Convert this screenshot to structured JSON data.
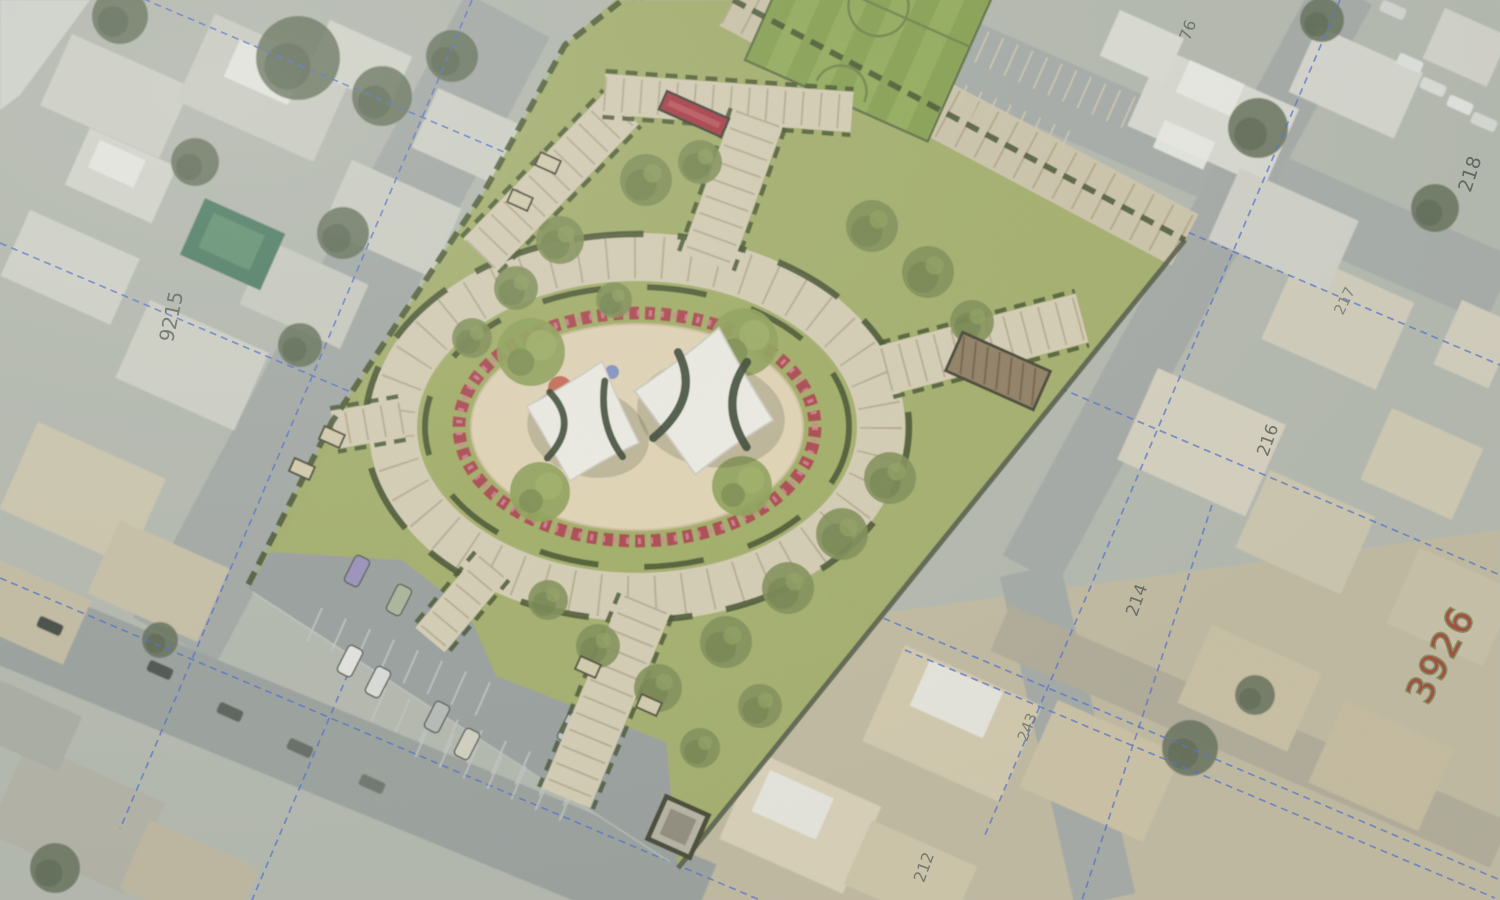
{
  "scene": {
    "description": "Aerial orthophoto of a city block with a landscape master-plan overlay of a neighborhood park: striped sports field, elliptical central plaza with two white shade-sail canopies, flower ring, hatched walkways, hedges, lawns with trees, and a parking lot with cars. Cadastral blue dashed parcel lines and rotated plot numbers over the satellite imagery.",
    "width": 1500,
    "height": 900
  },
  "colors": {
    "satellite_base": "#b5b9af",
    "beige_zone": "#c6bb9e",
    "lawn": "#a4af67",
    "tree_park": "#7d8d50",
    "tree_park_dark": "#66773f",
    "tree_park_light": "#93a35e",
    "tree_satellite": "#5f6b53",
    "path": "#d9d0b6",
    "path_hatch": "rgba(148,130,96,0.45)",
    "hedge": "#42502a",
    "boundary": "#4b5440",
    "sand": "#e6d7b7",
    "flower_red": "#ab4349",
    "flower_pink": "#d2808d",
    "parking_asphalt": "#999f9d",
    "parking_line": "#c2c7c3",
    "cadastral_blue": "#4f6ecb",
    "field_stripe_a": "#85a04c",
    "field_stripe_b": "#92ac57",
    "field_line": "#6e8245",
    "sail_fill": "#f2f0e8",
    "sail_edge": "#cfccc2",
    "sail_seam": "#323f2b",
    "pergola_fill": "#8f7b5f",
    "pergola_hatch": "#6e5d43",
    "bench_fill": "#d8cfae",
    "bench_stroke": "#4a4a35",
    "kiosk_fill": "#b9b4a4",
    "flowerbed_fill": "#a8323c",
    "white_roof": "#ecece6",
    "streak": "#d6d8d2"
  },
  "labels": [
    {
      "text": "9215",
      "x": 178,
      "y": 318,
      "rot": -78,
      "size": 20,
      "fill": "#565c55",
      "opacity": 0.85
    },
    {
      "text": "218",
      "x": 1476,
      "y": 176,
      "rot": -72,
      "size": 19,
      "fill": "#4e554e",
      "opacity": 0.9
    },
    {
      "text": "76",
      "x": 1193,
      "y": 32,
      "rot": -70,
      "size": 16,
      "fill": "#555b54",
      "opacity": 0.8
    },
    {
      "text": "217",
      "x": 1349,
      "y": 303,
      "rot": -64,
      "size": 15,
      "fill": "#5a6058",
      "opacity": 0.7
    },
    {
      "text": "216",
      "x": 1273,
      "y": 442,
      "rot": -70,
      "size": 17,
      "fill": "#51574f",
      "opacity": 0.85
    },
    {
      "text": "214",
      "x": 1142,
      "y": 602,
      "rot": -70,
      "size": 17,
      "fill": "#51574f",
      "opacity": 0.85
    },
    {
      "text": "243",
      "x": 1032,
      "y": 729,
      "rot": -68,
      "size": 15,
      "fill": "#5a5f56",
      "opacity": 0.75
    },
    {
      "text": "212",
      "x": 929,
      "y": 869,
      "rot": -70,
      "size": 16,
      "fill": "#565c55",
      "opacity": 0.8
    },
    {
      "text": "3926",
      "x": 1452,
      "y": 660,
      "rot": -62,
      "size": 36,
      "fill": "#9e3b2a",
      "opacity": 0.92,
      "serif": true,
      "halo": "#7d8a55"
    }
  ],
  "roads": [
    [
      508,
      15,
      175,
      640,
      95,
      "#a3a8a4"
    ],
    [
      0,
      618,
      700,
      905,
      88,
      "#9aa09c"
    ],
    [
      745,
      -40,
      1500,
      290,
      72,
      "#a6aba7"
    ],
    [
      1345,
      -10,
      1030,
      570,
      62,
      "#a4a9a5"
    ],
    [
      1030,
      570,
      1105,
      900,
      62,
      "#a4a9a5"
    ],
    [
      1000,
      628,
      1500,
      845,
      50,
      "#b2ab97"
    ]
  ],
  "beige_zone": [
    [
      660,
      900
    ],
    [
      640,
      800
    ],
    [
      830,
      620
    ],
    [
      1500,
      530
    ],
    [
      1500,
      900
    ]
  ],
  "corner_streak": [
    [
      0,
      0
    ],
    [
      90,
      0
    ],
    [
      20,
      95
    ],
    [
      0,
      110
    ]
  ],
  "buildings": [
    [
      72,
      34,
      130,
      78,
      "#d0d1c7"
    ],
    [
      215,
      14,
      150,
      95,
      "#cdcec4"
    ],
    [
      90,
      128,
      95,
      62,
      "#d6d6cc"
    ],
    [
      30,
      210,
      120,
      72,
      "#d3d4ca"
    ],
    [
      150,
      300,
      130,
      85,
      "#d0d1c6"
    ],
    [
      268,
      240,
      110,
      70,
      "#cbccc1"
    ],
    [
      352,
      160,
      120,
      75,
      "#cfd0c5"
    ],
    [
      438,
      88,
      100,
      65,
      "#d2d3c8"
    ],
    [
      330,
      20,
      90,
      55,
      "#d5d6cb"
    ],
    [
      38,
      422,
      140,
      95,
      "#cec6ad"
    ],
    [
      120,
      520,
      120,
      80,
      "#c9c0a6"
    ],
    [
      0,
      560,
      100,
      70,
      "#c4bca2"
    ],
    [
      28,
      742,
      150,
      100,
      "#b3b2a4"
    ],
    [
      150,
      820,
      120,
      75,
      "#c0b8a0"
    ],
    [
      0,
      680,
      90,
      60,
      "#a9aca1"
    ],
    [
      758,
      752,
      135,
      95,
      "#ddd3b8"
    ],
    [
      905,
      645,
      150,
      105,
      "#d6cbae"
    ],
    [
      1058,
      700,
      135,
      95,
      "#cfc3a5"
    ],
    [
      872,
      820,
      115,
      70,
      "#d2c7a9"
    ],
    [
      1212,
      625,
      120,
      85,
      "#cdc2a3"
    ],
    [
      1345,
      700,
      120,
      90,
      "#c8bd9e"
    ],
    [
      1158,
      368,
      140,
      100,
      "#d8d2bf"
    ],
    [
      1300,
      252,
      125,
      95,
      "#d4cebb"
    ],
    [
      1270,
      470,
      115,
      85,
      "#cfc7ae"
    ],
    [
      1392,
      408,
      100,
      78,
      "#d1cab1"
    ],
    [
      1420,
      548,
      105,
      82,
      "#cbc2a7"
    ],
    [
      1462,
      300,
      60,
      70,
      "#d6d0bd"
    ],
    [
      1162,
      48,
      150,
      85,
      "#dadad2"
    ],
    [
      1318,
      26,
      115,
      72,
      "#d7d7cf"
    ],
    [
      1445,
      8,
      70,
      55,
      "#d4d4cb"
    ],
    [
      1240,
      168,
      130,
      78,
      "#d2d2c9"
    ],
    [
      1120,
      10,
      70,
      50,
      "#dcdcd4"
    ]
  ],
  "white_roofs": [
    [
      240,
      40,
      70,
      40
    ],
    [
      100,
      140,
      50,
      30
    ],
    [
      1190,
      60,
      60,
      35
    ],
    [
      770,
      770,
      70,
      45
    ],
    [
      930,
      660,
      80,
      50
    ],
    [
      1165,
      120,
      55,
      30
    ]
  ],
  "pool": {
    "x": 205,
    "y": 198,
    "w": 88,
    "h": 62,
    "fill": "#497a5e",
    "inner": "#5d8f6e"
  },
  "satellite_trees": [
    [
      298,
      58,
      42
    ],
    [
      382,
      96,
      30
    ],
    [
      452,
      56,
      26
    ],
    [
      195,
      162,
      24
    ],
    [
      120,
      16,
      28
    ],
    [
      343,
      233,
      26
    ],
    [
      300,
      345,
      22
    ],
    [
      1258,
      128,
      30
    ],
    [
      1435,
      208,
      24
    ],
    [
      1322,
      20,
      22
    ],
    [
      55,
      868,
      25
    ],
    [
      160,
      640,
      18
    ],
    [
      1190,
      748,
      28
    ],
    [
      1255,
      695,
      20
    ]
  ],
  "street_cars": [
    [
      50,
      626,
      "#41463f"
    ],
    [
      160,
      670,
      "#4a4f49"
    ],
    [
      230,
      712,
      "#575c55"
    ],
    [
      300,
      748,
      "#626760"
    ],
    [
      372,
      784,
      "#6d716a"
    ],
    [
      1410,
      63,
      "#e2e3df"
    ],
    [
      1433,
      87,
      "#dcded9"
    ],
    [
      1460,
      105,
      "#e5e6e2"
    ],
    [
      1484,
      122,
      "#d8dad5"
    ],
    [
      1393,
      10,
      "#d4d6d1"
    ]
  ],
  "blue_lines": [
    [
      472,
      0,
      120,
      829
    ],
    [
      634,
      0,
      252,
      900
    ],
    [
      1340,
      0,
      985,
      835
    ],
    [
      1212,
      505,
      1082,
      900
    ],
    [
      0,
      243,
      1500,
      880
    ],
    [
      548,
      -40,
      1500,
      365
    ],
    [
      0,
      -62,
      1500,
      575
    ],
    [
      0,
      578,
      760,
      900
    ],
    [
      905,
      650,
      1495,
      898
    ]
  ],
  "park": {
    "lawn": [
      [
        615,
        0
      ],
      [
        733,
        0
      ],
      [
        1185,
        240
      ],
      [
        678,
        868
      ],
      [
        248,
        588
      ],
      [
        332,
        422
      ],
      [
        484,
        192
      ],
      [
        565,
        45
      ]
    ],
    "parking": {
      "poly": [
        [
          270,
          552
        ],
        [
          402,
          560
        ],
        [
          468,
          612
        ],
        [
          496,
          676
        ],
        [
          666,
          742
        ],
        [
          678,
          868
        ],
        [
          248,
          588
        ]
      ],
      "fill": "#999f9d"
    },
    "parking_rows": [
      [
        322,
        608,
        8
      ],
      [
        386,
        688,
        9
      ],
      [
        430,
        724,
        7
      ]
    ],
    "parking_edge_line": [
      252,
      592,
      670,
      862
    ],
    "plan_cars": [
      [
        357,
        571,
        "#9a8fbc"
      ],
      [
        399,
        600,
        "#a9b79a"
      ],
      [
        350,
        661,
        "#e8e8e4"
      ],
      [
        378,
        682,
        "#dfe0dc"
      ],
      [
        437,
        717,
        "#b9bdb9"
      ],
      [
        467,
        744,
        "#d8d3c2"
      ],
      [
        570,
        728,
        "#c7c9c4"
      ]
    ],
    "field": {
      "tx": 745,
      "ty": 60,
      "rot": 24,
      "w": 200,
      "h": 230
    },
    "ne_road": {
      "x1": 733,
      "y1": 0,
      "x2": 1185,
      "y2": 240,
      "w": 58,
      "fill": "#cfc6aa"
    },
    "street_parking": {
      "tx": 945,
      "ty": 12,
      "rot": 24,
      "n": 14,
      "step": 16,
      "len": 34,
      "row2_dx": -30,
      "row2_y": 58
    },
    "paths": [
      [
        480,
        255,
        622,
        108,
        46
      ],
      [
        604,
        94,
        852,
        112,
        40
      ],
      [
        758,
        118,
        706,
        262,
        52
      ],
      [
        886,
        370,
        1082,
        318,
        50
      ],
      [
        646,
        604,
        566,
        798,
        52
      ],
      [
        492,
        566,
        430,
        640,
        38
      ],
      [
        402,
        418,
        334,
        430,
        38
      ]
    ],
    "boundary_hedges": [
      [
        [
          620,
          2
        ],
        [
          565,
          45
        ],
        [
          484,
          192
        ],
        [
          332,
          422
        ],
        [
          247,
          587
        ]
      ],
      [
        [
          733,
          0
        ],
        [
          1185,
          240
        ]
      ],
      [
        [
          1185,
          240
        ],
        [
          678,
          868
        ]
      ]
    ],
    "plaza": {
      "cx": 637,
      "cy": 427,
      "lawn_rx": 216,
      "lawn_ry": 144,
      "ring_rx": 244,
      "ring_ry": 170,
      "ring_w": 48,
      "hedge_out_rx": 272,
      "hedge_out_ry": 193,
      "hedge_in_rx": 212,
      "hedge_in_ry": 140,
      "red_rx": 178,
      "red_ry": 114,
      "sand_rx": 166,
      "sand_ry": 103
    },
    "plaza_trees": [
      [
        531,
        352,
        34
      ],
      [
        744,
        342,
        34
      ],
      [
        540,
        492,
        30
      ],
      [
        742,
        486,
        30
      ]
    ],
    "park_trees": [
      [
        646,
        180,
        26
      ],
      [
        700,
        162,
        22
      ],
      [
        560,
        240,
        24
      ],
      [
        516,
        288,
        22
      ],
      [
        472,
        338,
        20
      ],
      [
        614,
        300,
        18
      ],
      [
        872,
        226,
        26
      ],
      [
        928,
        272,
        26
      ],
      [
        972,
        322,
        22
      ],
      [
        890,
        478,
        26
      ],
      [
        842,
        534,
        26
      ],
      [
        788,
        588,
        26
      ],
      [
        726,
        642,
        26
      ],
      [
        658,
        688,
        24
      ],
      [
        598,
        646,
        22
      ],
      [
        548,
        600,
        20
      ],
      [
        760,
        706,
        22
      ],
      [
        700,
        748,
        20
      ]
    ],
    "benches": [
      [
        548,
        163
      ],
      [
        520,
        200
      ],
      [
        332,
        437
      ],
      [
        302,
        469
      ],
      [
        588,
        667
      ],
      [
        649,
        705
      ]
    ],
    "flowerbed": {
      "tx": 694,
      "ty": 114,
      "rot": 24,
      "w": 68,
      "h": 20
    },
    "pergola": {
      "tx": 998,
      "ty": 371,
      "rot": 24,
      "w": 96,
      "h": 42
    },
    "kiosk": {
      "tx": 678,
      "ty": 827,
      "rot": 24,
      "size": 46
    },
    "sails": {
      "outline": "M0,-62 Q28,-26 58,6 Q26,34 2,62 Q-28,32 -60,2 Q-30,-26 0,-62 Z",
      "left": {
        "tx": 585,
        "ty": 421,
        "rot": 16,
        "scale": 1.0,
        "seams": [
          "M-42,-18 Q-4,4 -26,46",
          "M8,-44 Q14,0 46,24"
        ]
      },
      "right": {
        "tx": 706,
        "ty": 401,
        "rot": 10,
        "scale": 1.2,
        "seams": [
          "M-30,-36 Q-4,-2 -38,38",
          "M28,-38 Q10,0 40,32"
        ]
      }
    },
    "play_colors": [
      [
        560,
        388,
        12,
        "#c4563f"
      ],
      [
        596,
        409,
        8,
        "#d28a50"
      ],
      [
        612,
        372,
        7,
        "#7287c6"
      ],
      [
        553,
        416,
        6,
        "#d98f9b"
      ],
      [
        571,
        452,
        9,
        "#8d80c4"
      ],
      [
        663,
        386,
        6,
        "#c0563f"
      ],
      [
        737,
        424,
        8,
        "#7fa055"
      ],
      [
        690,
        432,
        6,
        "#7d88c0"
      ],
      [
        714,
        402,
        16,
        "#db93a2"
      ]
    ]
  }
}
